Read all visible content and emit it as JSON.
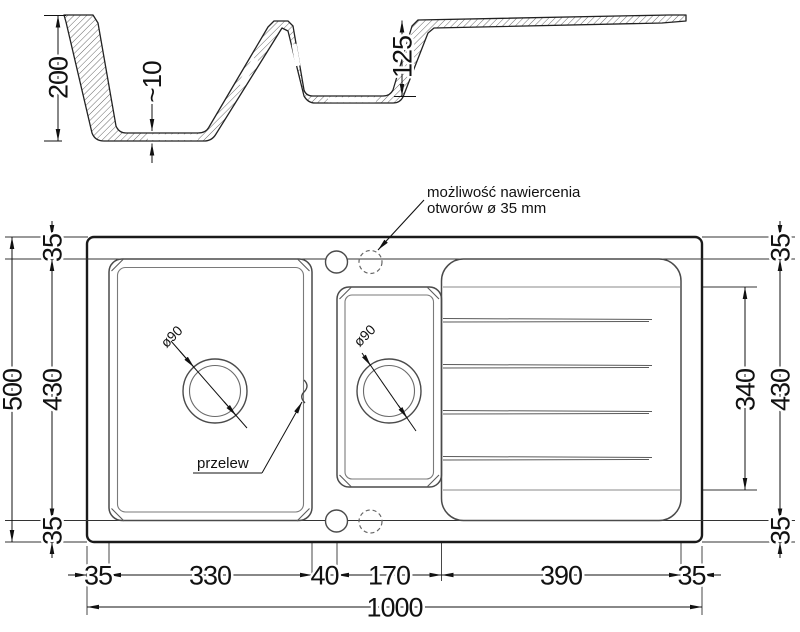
{
  "drawing_type": "sink-technical-drawing",
  "colors": {
    "line": "#1a1a1a",
    "secondary": "#4a4a4a",
    "background": "#ffffff"
  },
  "note": {
    "line1": "możliwość nawiercenia",
    "line2": "otworów ø 35 mm"
  },
  "section": {
    "total_depth": "200",
    "bottom_thickness": "~10",
    "small_bowl_depth": "125"
  },
  "plan": {
    "overflow_label": "przelew",
    "main_drain_diameter": "ø90",
    "small_drain_diameter": "ø90",
    "left": {
      "total_height": "500",
      "inner_height": "430",
      "margin_top": "35",
      "margin_bottom": "35"
    },
    "right": {
      "margin_top": "35",
      "inner_height": "430",
      "margin_bottom": "35",
      "drainer_height": "340"
    },
    "bottom": {
      "margin_left": "35",
      "main_bowl": "330",
      "gap": "40",
      "small_bowl": "170",
      "drainer": "390",
      "margin_right": "35",
      "total_width": "1000"
    }
  }
}
